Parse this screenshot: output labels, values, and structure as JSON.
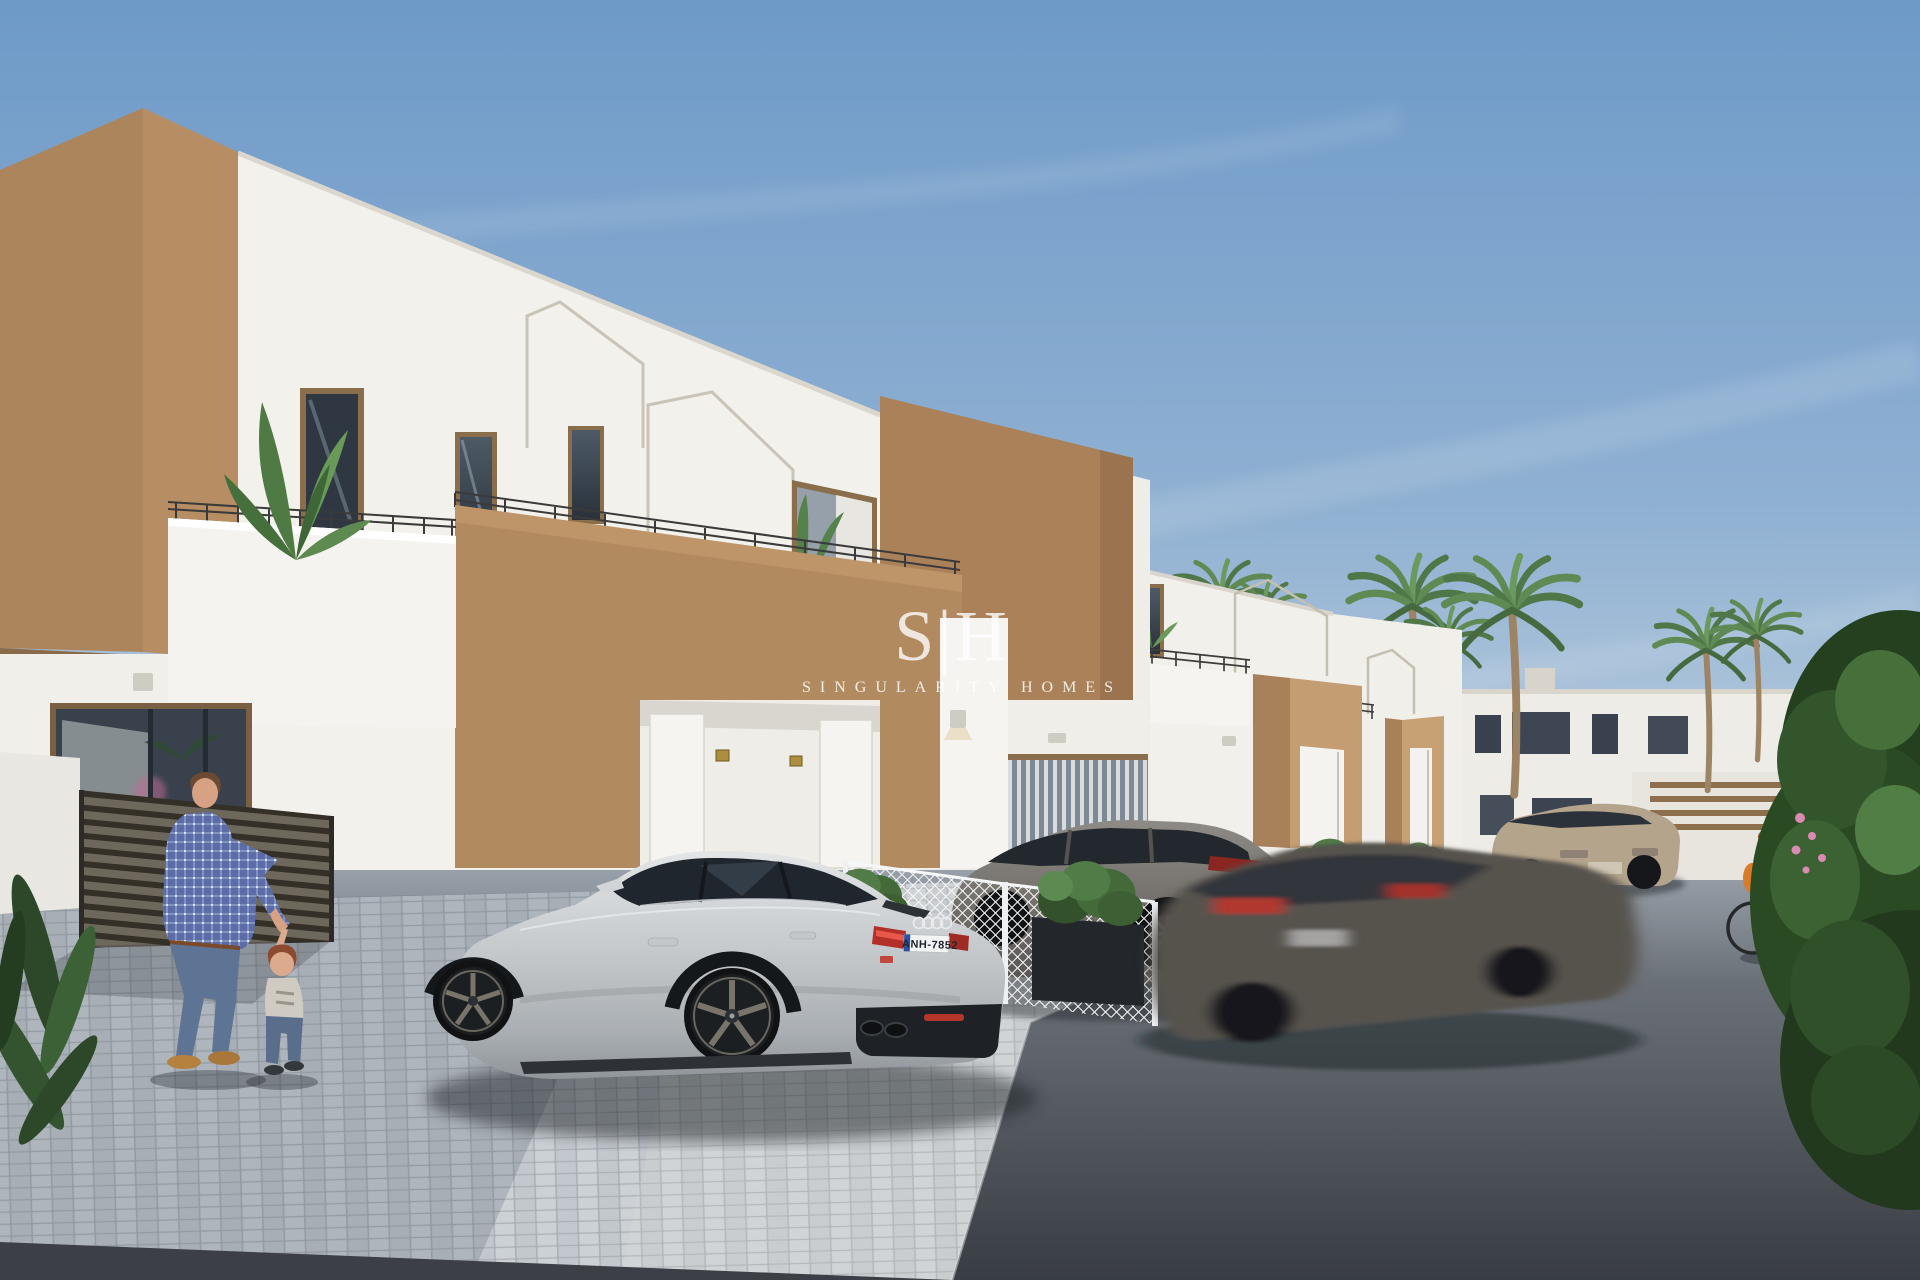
{
  "scene": {
    "type": "3d-architectural-render",
    "subject": "Street view of new-build two-storey townhouses with roof terraces, parked cars, palm trees and pedestrians",
    "sky": "clear blue sky with thin cirrus clouds"
  },
  "watermark": {
    "logo": "S|H",
    "name": "SINGULARITY HOMES"
  },
  "vehicles": {
    "hero_car": {
      "type": "silver sportback coupe",
      "plate": "ANH-7852"
    },
    "suv": "grey SUV parked behind mesh fence",
    "sedan": "grey sedan driving with motion blur",
    "crossover": "beige crossover parked on road"
  },
  "people": {
    "man": "man in blue plaid shirt and jeans playing with toddler",
    "toddler": "toddler in white t-shirt and jeans",
    "cyclist": "woman in yellow top riding a bicycle"
  },
  "architecture": {
    "walls": [
      "white render",
      "camel brown render"
    ],
    "features": [
      "roof terraces with thin black railings",
      "house-shaped parapet trims",
      "recessed garage entries with white doors",
      "gold house-number plaques",
      "wall lanterns",
      "white wire-mesh fences",
      "dark slatted gate"
    ]
  },
  "vegetation": [
    "palm trees",
    "terrace banana plants",
    "box planters with shrubs",
    "large green hedge",
    "foreground leaves"
  ],
  "ground": {
    "driveway": "light grey cobble pavers",
    "road": "dark asphalt"
  },
  "colors": {
    "sky_top": "#6e9ac8",
    "sky_horizon": "#c6d5e1",
    "wall_white": "#f2f0ea",
    "wall_brown": "#b28a60",
    "wall_brown_shade": "#a37e57",
    "paver": "#c8cdd2",
    "asphalt": "#43484e",
    "palm_green": "#57804c",
    "hedge_green": "#2f4e2a",
    "plate_blue": "#2a4fa3",
    "taillight_red": "#b23028",
    "plaque_gold": "#ab8f3e"
  }
}
